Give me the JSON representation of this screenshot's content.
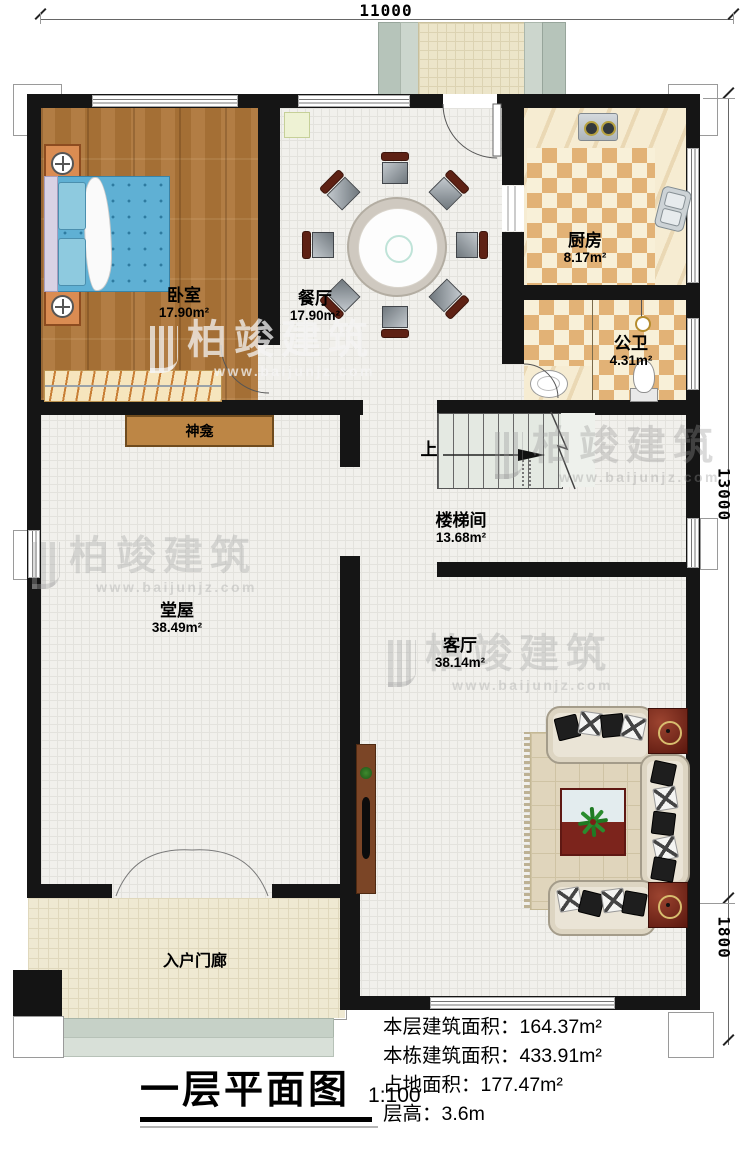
{
  "plan": {
    "title": "一层平面图",
    "scale": "1:100",
    "dims": {
      "top": "11000",
      "right_upper": "13000",
      "right_lower": "1800"
    },
    "rooms": {
      "bedroom": {
        "name": "卧室",
        "area": "17.90m²"
      },
      "dining": {
        "name": "餐厅",
        "area": "17.90m²"
      },
      "kitchen": {
        "name": "厨房",
        "area": "8.17m²"
      },
      "bath": {
        "name": "公卫",
        "area": "4.31m²"
      },
      "stair": {
        "name": "楼梯间",
        "area": "13.68m²"
      },
      "hall": {
        "name": "堂屋",
        "area": "38.49m²"
      },
      "living": {
        "name": "客厅",
        "area": "38.14m²"
      },
      "porch": {
        "name": "入户门廊"
      }
    },
    "labels": {
      "shrine": "神龛",
      "up": "上"
    },
    "stats": [
      {
        "label": "本层建筑面积：",
        "value": "164.37m²"
      },
      {
        "label": "本栋建筑面积：",
        "value": "433.91m²"
      },
      {
        "label": "占地面积：",
        "value": "177.47m²"
      },
      {
        "label": "层高：",
        "value": "3.6m"
      }
    ],
    "watermark": {
      "brand": "柏竣建筑",
      "site": "www.baijunjz.com"
    }
  }
}
